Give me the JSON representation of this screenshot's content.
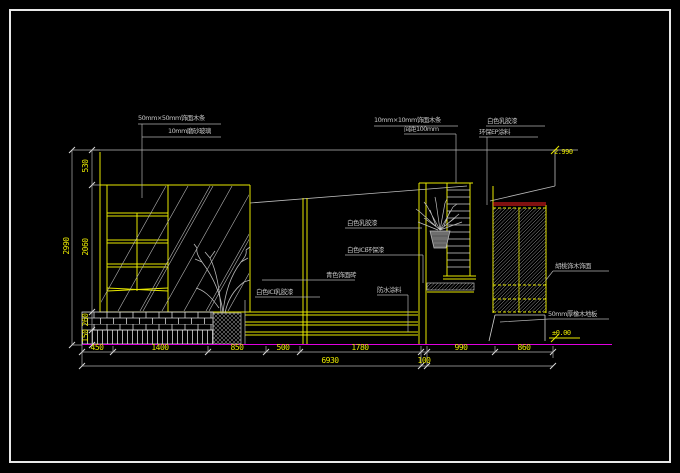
{
  "drawing": {
    "type": "CAD interior elevation",
    "annotations": {
      "top_left_1": "50mm×50mm饰面木条",
      "top_left_2": "10mm磨砂玻璃",
      "top_mid_1": "10mm×10mm饰面木条",
      "top_mid_2": "间距100mm",
      "top_right_1": "白色乳胶漆",
      "top_right_2": "环保EP涂料",
      "mid_paint": "白色乳胶漆",
      "mid_ici": "白色ICI环保漆",
      "mid_tile": "青色饰面砖",
      "mid_ici2": "白色ICI乳胶漆",
      "mid_waterproof": "防水涂料",
      "right_veneer": "胡桃饰木饰面",
      "right_floor": "50mm厚橡木地板"
    },
    "levels": {
      "top": "2.990",
      "bottom": "±0.00"
    },
    "dims": {
      "bottom_row1": [
        "450",
        "1400",
        "850",
        "500",
        "1780",
        "990",
        "860"
      ],
      "bottom_gap": "100",
      "bottom_total": "6930",
      "left_col": [
        "530",
        "2060",
        "260",
        "150"
      ],
      "left_total": "2990"
    },
    "colors": {
      "background": "#000000",
      "frame": "#e8e8e8",
      "structure": "#e8e800",
      "dimension_text": "#e8e800",
      "annotation_text": "#c4c4c4",
      "accent_red": "#ff2020",
      "floor_magenta": "#e000e0",
      "hatch": "#a0a0a0"
    }
  }
}
